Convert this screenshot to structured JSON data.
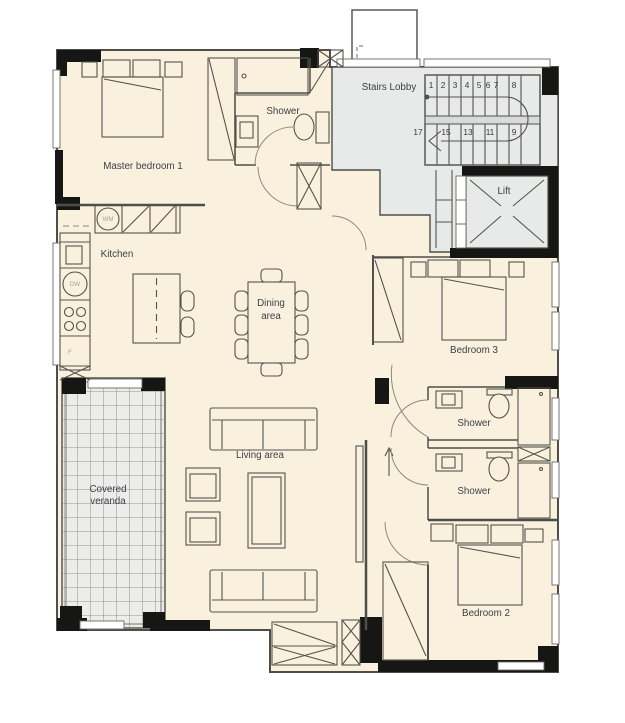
{
  "drawing": {
    "title": "apartment-floor-plan",
    "rooms": {
      "master_bedroom": "Master bedroom 1",
      "ensuite_shower": "Shower",
      "stairs_lobby": "Stairs Lobby",
      "lift": "Lift",
      "kitchen": "Kitchen",
      "dining_line1": "Dining",
      "dining_line2": "area",
      "living": "Living area",
      "veranda_line1": "Covered",
      "veranda_line2": "veranda",
      "bedroom3": "Bedroom 3",
      "shower_a": "Shower",
      "shower_b": "Shower",
      "bedroom2": "Bedroom 2"
    },
    "stairs": {
      "up": [
        "1",
        "2",
        "3",
        "4",
        "5",
        "6",
        "7",
        "8"
      ],
      "down": [
        "17",
        "15",
        "13",
        "11",
        "9"
      ]
    },
    "appliances": {
      "washing_machine": "WM",
      "dishwasher": "DW",
      "fridge": "F"
    },
    "colors": {
      "floor": "#f9f1de",
      "lobby": "#e8eae9",
      "veranda_tile": "#ecedea",
      "wall": "#4f4d48",
      "column": "#161614",
      "text": "#3a3f46"
    }
  }
}
